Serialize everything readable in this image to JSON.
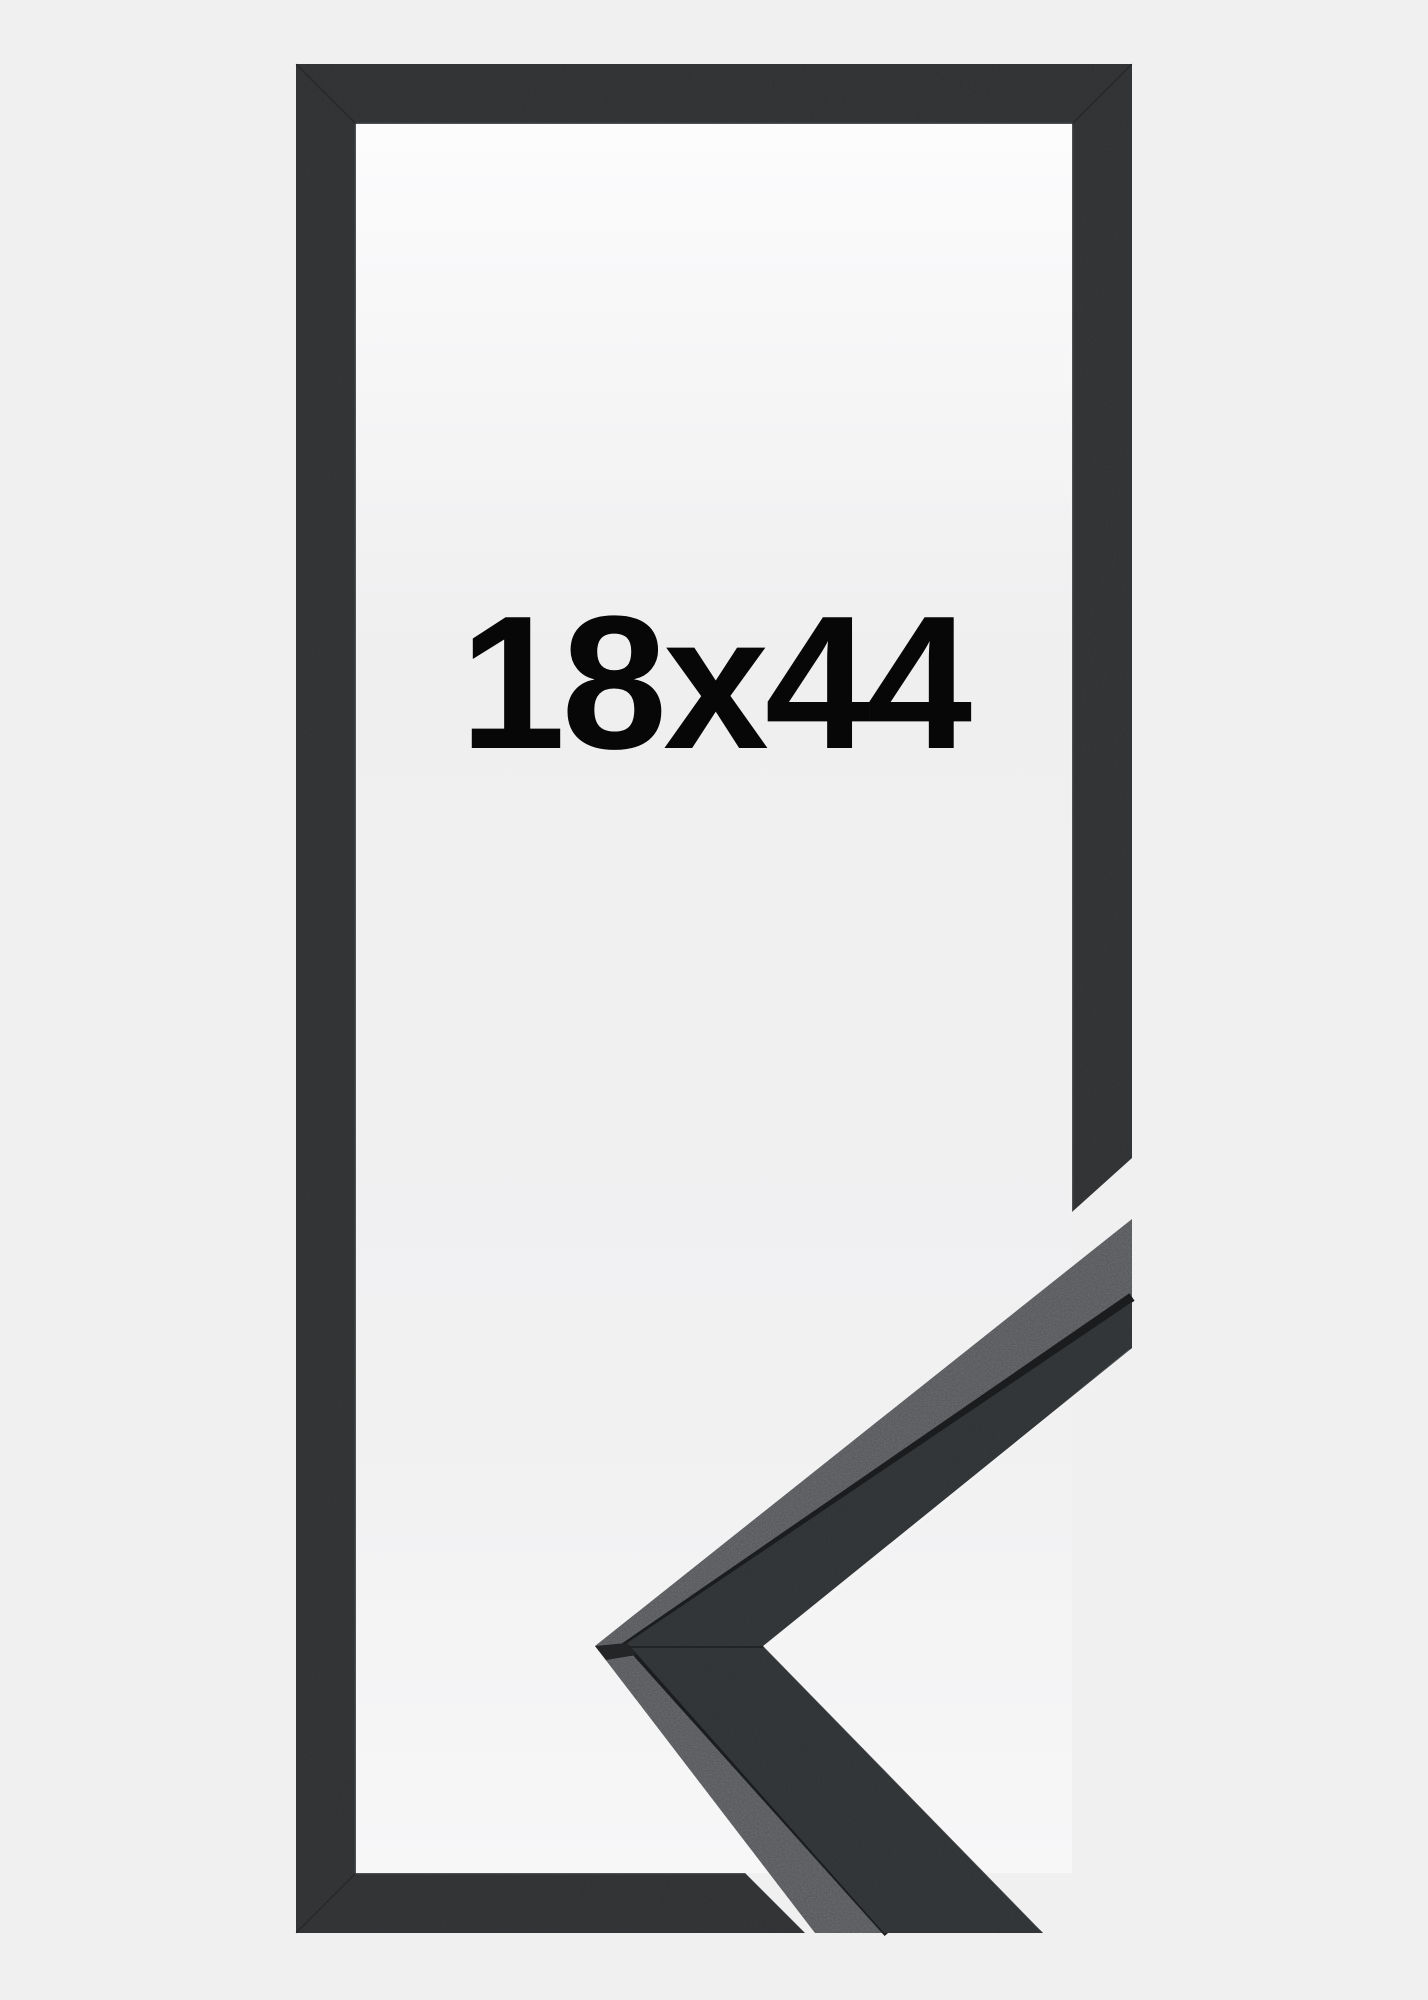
{
  "product": {
    "size_label": "18x44",
    "description": "black frame corner sample product image"
  },
  "colors": {
    "background": "#f0f0f1",
    "frame_front": "#2e3032",
    "corner_face": "#2f3234",
    "corner_top_edge": "#4e5053",
    "corner_edge_line": "#1a1c1e",
    "label_text": "#070707",
    "inner_top": "#fcfcfd",
    "inner_mid": "#efeff0",
    "inner_low": "#f1f1f2",
    "inner_bottom": "#f7f7f8"
  }
}
